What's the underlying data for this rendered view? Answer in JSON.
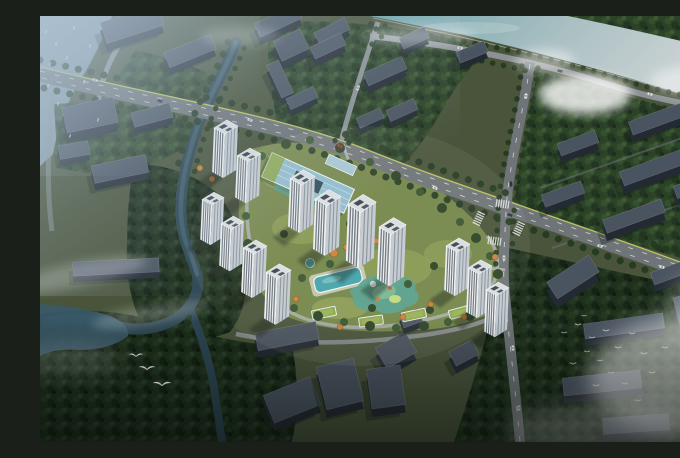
{
  "scene": {
    "type": "aerial-architectural-rendering",
    "subject": "residential-masterplan-birdseye-view",
    "palette": {
      "base": "#49543b",
      "river1": "#6fa5ab",
      "river2": "#ccd3d4",
      "canal": "#2d4652",
      "canal_hi": "#44636f",
      "lake": "#3a5969",
      "harbor": "#8ba3b5",
      "canopy_mid": "#2c4327",
      "canopy_dark": "#1d2e1c",
      "lawn": "#74864a",
      "lawn_bright": "#96a558",
      "road": "#6e7477",
      "road_minor": "#8b9194",
      "road_light": "#a9aeaa",
      "lane": "#cbd74e",
      "tower_face": "#eef0f2",
      "tower_side": "#c3cad1",
      "tower_stripe": "#56616c",
      "tower_roof": "#d9dee1",
      "roof_panel": "#39434e",
      "ctx_roof": "#4a5460",
      "ctx_face": "#232a33",
      "shadow": "#0d1911",
      "glass": "#8fbcce",
      "glass_dark": "#2e4a58",
      "pool": "#43a3ab",
      "playground": "#57a08e",
      "playground_in": "#79b794",
      "orange": "#c9813a",
      "green_roof": "#8aa650",
      "mist": "#ffffff"
    },
    "towers": [
      [
        174,
        106,
        0.92,
        1.0
      ],
      [
        197,
        134,
        0.92,
        0.95
      ],
      [
        162,
        178,
        0.85,
        0.91
      ],
      [
        181,
        202,
        0.88,
        0.95
      ],
      [
        203,
        226,
        0.92,
        1.0
      ],
      [
        226,
        250,
        0.96,
        1.05
      ],
      [
        250,
        156,
        0.96,
        1.09
      ],
      [
        275,
        176,
        1.0,
        1.14
      ],
      [
        308,
        181,
        1.08,
        1.27
      ],
      [
        339,
        204,
        1.04,
        1.18
      ],
      [
        406,
        224,
        0.92,
        1.0
      ],
      [
        428,
        246,
        0.92,
        1.0
      ],
      [
        446,
        268,
        0.88,
        0.95
      ]
    ],
    "context_buildings": [
      [
        92,
        16,
        60,
        22,
        -18,
        8
      ],
      [
        150,
        42,
        50,
        16,
        -22,
        7
      ],
      [
        238,
        12,
        46,
        15,
        -25,
        7
      ],
      [
        292,
        22,
        34,
        13,
        -27,
        7
      ],
      [
        50,
        108,
        52,
        26,
        -12,
        9
      ],
      [
        112,
        106,
        40,
        15,
        -15,
        7
      ],
      [
        34,
        140,
        30,
        14,
        -10,
        6
      ],
      [
        80,
        160,
        55,
        18,
        -12,
        7
      ],
      [
        76,
        257,
        86,
        14,
        -3,
        6
      ],
      [
        251,
        37,
        30,
        22,
        -25,
        8
      ],
      [
        288,
        37,
        34,
        13,
        -25,
        7
      ],
      [
        240,
        70,
        36,
        13,
        65,
        7
      ],
      [
        262,
        88,
        30,
        12,
        -25,
        6
      ],
      [
        345,
        62,
        42,
        14,
        -24,
        7
      ],
      [
        362,
        100,
        30,
        12,
        -24,
        6
      ],
      [
        330,
        108,
        26,
        11,
        -24,
        6
      ],
      [
        374,
        28,
        28,
        12,
        -24,
        6
      ],
      [
        432,
        42,
        30,
        12,
        -22,
        6
      ],
      [
        538,
        134,
        40,
        13,
        -20,
        7
      ],
      [
        612,
        160,
        64,
        15,
        -20,
        8
      ],
      [
        523,
        185,
        42,
        13,
        -20,
        7
      ],
      [
        594,
        208,
        62,
        14,
        -20,
        8
      ],
      [
        656,
        176,
        44,
        13,
        -20,
        7
      ],
      [
        617,
        110,
        56,
        14,
        -20,
        7
      ],
      [
        634,
        262,
        46,
        13,
        -20,
        7
      ],
      [
        533,
        270,
        50,
        20,
        -33,
        9
      ],
      [
        584,
        317,
        80,
        15,
        -8,
        7
      ],
      [
        649,
        300,
        26,
        28,
        -15,
        8
      ],
      [
        562,
        374,
        78,
        18,
        -6,
        7
      ],
      [
        596,
        415,
        66,
        16,
        -4,
        7
      ],
      [
        356,
        342,
        34,
        24,
        -30,
        8
      ],
      [
        247,
        327,
        62,
        18,
        -11,
        7
      ],
      [
        252,
        392,
        50,
        30,
        -22,
        8
      ],
      [
        300,
        376,
        38,
        44,
        -14,
        8
      ],
      [
        346,
        379,
        34,
        40,
        -8,
        8
      ],
      [
        371,
        308,
        20,
        14,
        -20,
        6
      ],
      [
        424,
        344,
        26,
        16,
        -28,
        7
      ]
    ],
    "site_trees": [
      [
        210,
        150,
        5
      ],
      [
        222,
        140,
        4
      ],
      [
        246,
        128,
        5
      ],
      [
        270,
        124,
        4
      ],
      [
        300,
        132,
        5
      ],
      [
        330,
        146,
        4
      ],
      [
        356,
        160,
        5
      ],
      [
        380,
        176,
        4
      ],
      [
        402,
        192,
        5
      ],
      [
        420,
        206,
        4
      ],
      [
        436,
        222,
        5
      ],
      [
        450,
        240,
        4
      ],
      [
        458,
        258,
        5
      ],
      [
        452,
        286,
        4
      ],
      [
        430,
        300,
        5
      ],
      [
        408,
        306,
        4
      ],
      [
        384,
        310,
        5
      ],
      [
        356,
        312,
        4
      ],
      [
        330,
        310,
        5
      ],
      [
        304,
        306,
        4
      ],
      [
        278,
        300,
        5
      ],
      [
        254,
        292,
        4
      ],
      [
        232,
        276,
        5
      ],
      [
        216,
        254,
        4
      ],
      [
        208,
        228,
        5
      ],
      [
        206,
        200,
        4
      ],
      [
        206,
        172,
        5
      ],
      [
        290,
        248,
        4
      ],
      [
        320,
        240,
        4
      ],
      [
        368,
        268,
        4
      ],
      [
        332,
        292,
        4
      ],
      [
        262,
        262,
        4
      ],
      [
        244,
        218,
        4
      ],
      [
        268,
        196,
        4
      ],
      [
        310,
        208,
        4
      ],
      [
        348,
        232,
        4
      ],
      [
        394,
        250,
        4
      ],
      [
        414,
        272,
        4
      ],
      [
        390,
        294,
        4
      ]
    ],
    "autumn_trees": [
      [
        294,
        237,
        4
      ],
      [
        306,
        231,
        3
      ],
      [
        283,
        227,
        3
      ],
      [
        419,
        251,
        4
      ],
      [
        433,
        267,
        4
      ],
      [
        447,
        283,
        4
      ],
      [
        391,
        288,
        3
      ],
      [
        363,
        301,
        3
      ],
      [
        300,
        311,
        3
      ],
      [
        256,
        283,
        3
      ],
      [
        336,
        225,
        3
      ],
      [
        424,
        301,
        3
      ],
      [
        441,
        296,
        3
      ],
      [
        455,
        241,
        3
      ],
      [
        160,
        152,
        3
      ],
      [
        172,
        163,
        3
      ]
    ],
    "roof_gardens": [
      [
        284,
        297,
        -12
      ],
      [
        331,
        305,
        -8
      ],
      [
        374,
        299,
        -12
      ],
      [
        421,
        296,
        -15
      ]
    ],
    "crosswalks": [
      [
        463,
        188,
        8
      ],
      [
        455,
        225,
        8
      ],
      [
        439,
        202,
        -65
      ],
      [
        479,
        212,
        -65
      ]
    ],
    "cars": [
      [
        55,
        64,
        16,
        "#e9e9e9"
      ],
      [
        120,
        85,
        17,
        "#2f353b"
      ],
      [
        210,
        104,
        20,
        "#e0e0e0"
      ],
      [
        300,
        130,
        23,
        "#b93a2e"
      ],
      [
        395,
        172,
        19,
        "#e9e9e9"
      ],
      [
        470,
        199,
        18,
        "#31373d"
      ],
      [
        560,
        230,
        17,
        "#dcdfe2"
      ],
      [
        622,
        251,
        17,
        "#e9e9e9"
      ],
      [
        648,
        259,
        17,
        "#3d5a86"
      ],
      [
        486,
        80,
        95,
        "#e9e9e9"
      ],
      [
        471,
        168,
        86,
        "#30363c"
      ],
      [
        464,
        242,
        88,
        "#dcdfe2"
      ],
      [
        473,
        332,
        85,
        "#e9e9e9"
      ],
      [
        479,
        392,
        87,
        "#c0c4c8"
      ],
      [
        420,
        32,
        10,
        "#dcdfe2"
      ],
      [
        520,
        55,
        14,
        "#2f353b"
      ],
      [
        610,
        78,
        12,
        "#e9e9e9"
      ],
      [
        318,
        72,
        -70,
        "#dcdfe2"
      ]
    ],
    "birds": {
      "flock_left": [
        [
          96,
          340,
          1.5
        ],
        [
          107,
          353,
          1.7
        ],
        [
          122,
          369,
          1.9
        ]
      ],
      "flock_right": [
        [
          524,
          317,
          0.7
        ],
        [
          538,
          309,
          0.8
        ],
        [
          552,
          322,
          0.7
        ],
        [
          566,
          315,
          0.8
        ],
        [
          547,
          336,
          0.7
        ],
        [
          533,
          348,
          0.8
        ],
        [
          560,
          345,
          0.7
        ],
        [
          578,
          332,
          0.8
        ],
        [
          592,
          318,
          0.7
        ],
        [
          604,
          338,
          0.8
        ],
        [
          571,
          357,
          0.7
        ],
        [
          556,
          370,
          0.8
        ],
        [
          585,
          368,
          0.7
        ],
        [
          612,
          357,
          0.8
        ],
        [
          625,
          332,
          0.7
        ],
        [
          598,
          385,
          0.8
        ],
        [
          544,
          300,
          0.6
        ]
      ],
      "sailboats": [
        [
          6,
          16
        ],
        [
          16,
          28
        ],
        [
          27,
          42
        ],
        [
          10,
          48
        ],
        [
          34,
          12
        ],
        [
          50,
          30
        ],
        [
          44,
          66
        ],
        [
          18,
          88
        ],
        [
          8,
          70
        ],
        [
          58,
          104
        ],
        [
          30,
          120
        ]
      ]
    }
  }
}
